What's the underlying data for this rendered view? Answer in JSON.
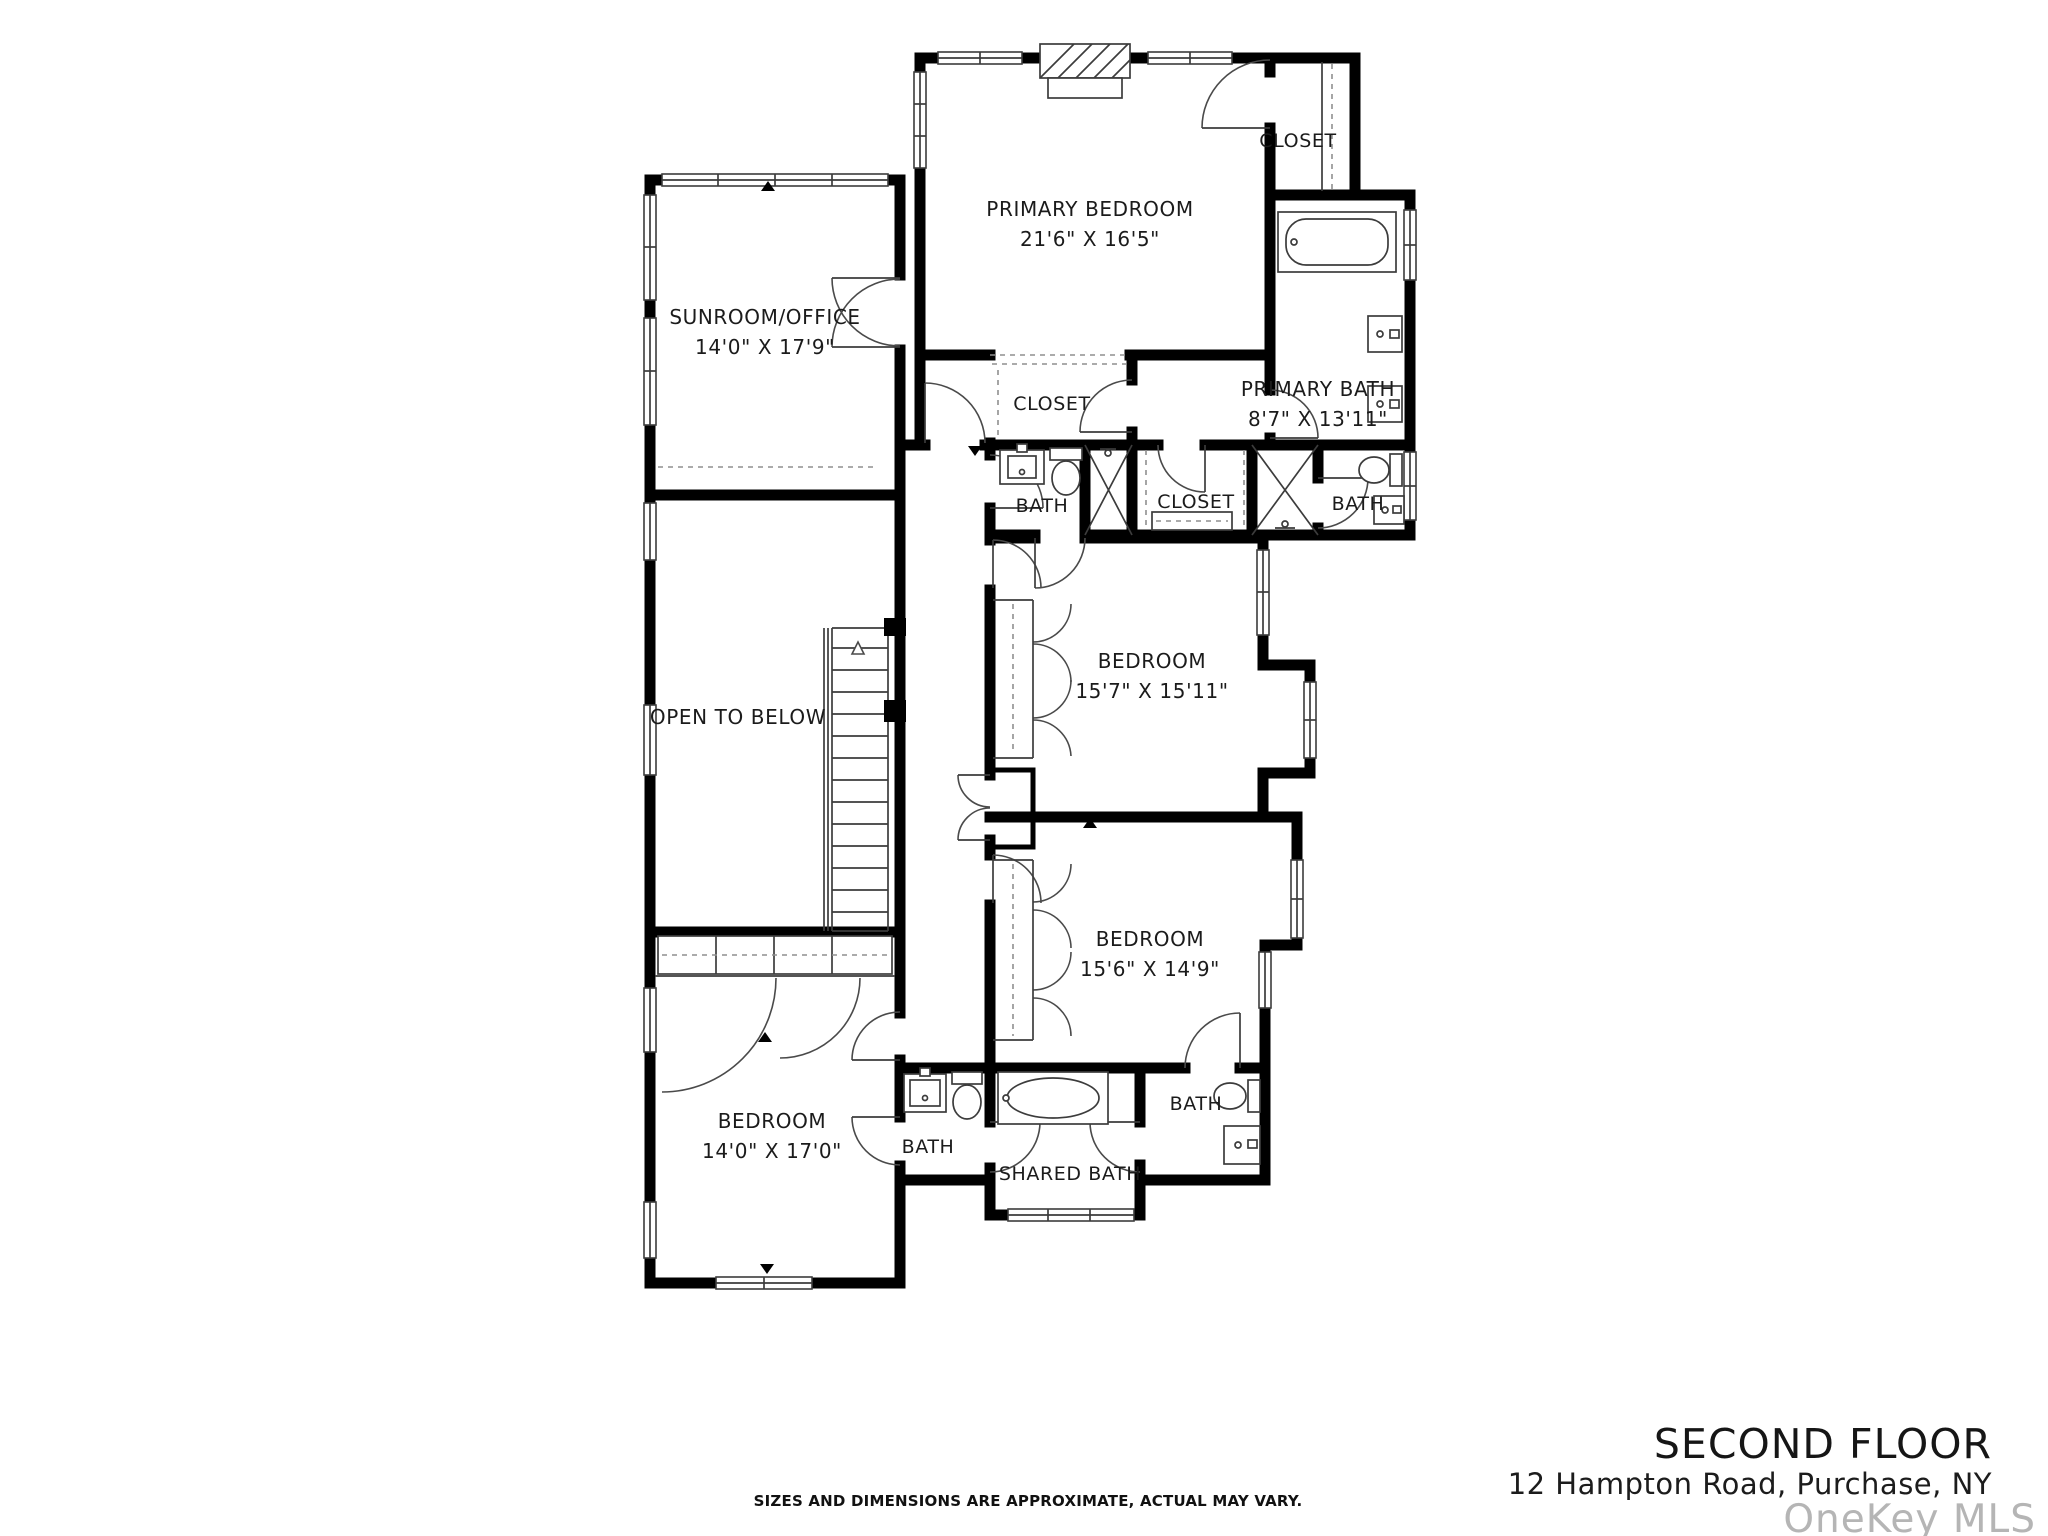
{
  "plan": {
    "rooms": {
      "primary_bedroom": {
        "name": "PRIMARY BEDROOM",
        "dims": "21'6\" X 16'5\""
      },
      "sunroom_office": {
        "name": "SUNROOM/OFFICE",
        "dims": "14'0\" X 17'9\""
      },
      "primary_bath": {
        "name": "PRIMARY BATH",
        "dims": "8'7\" X 13'11\""
      },
      "closet_top_right": {
        "name": "CLOSET"
      },
      "closet_mid_left": {
        "name": "CLOSET"
      },
      "bath_mid_left": {
        "name": "BATH"
      },
      "closet_mid": {
        "name": "CLOSET"
      },
      "bath_mid_right": {
        "name": "BATH"
      },
      "open_to_below": {
        "name": "OPEN TO BELOW"
      },
      "bedroom_mid": {
        "name": "BEDROOM",
        "dims": "15'7\" X 15'11\""
      },
      "bedroom_lower": {
        "name": "BEDROOM",
        "dims": "15'6\" X 14'9\""
      },
      "bedroom_left": {
        "name": "BEDROOM",
        "dims": "14'0\" X 17'0\""
      },
      "bath_bottom_left": {
        "name": "BATH"
      },
      "shared_bath": {
        "name": "SHARED BATH"
      },
      "bath_bottom_right": {
        "name": "BATH"
      }
    }
  },
  "footer": {
    "disclaimer": "SIZES AND DIMENSIONS ARE APPROXIMATE, ACTUAL MAY VARY."
  },
  "title_block": {
    "floor": "SECOND FLOOR",
    "address": "12 Hampton Road, Purchase, NY",
    "watermark": "OneKey MLS"
  },
  "colors": {
    "wall": "#000000",
    "line": "#3c3c3c",
    "dashed": "#8f8f8f",
    "text": "#1b1b1b",
    "watermark": "#b5b5b5",
    "background": "#ffffff"
  }
}
